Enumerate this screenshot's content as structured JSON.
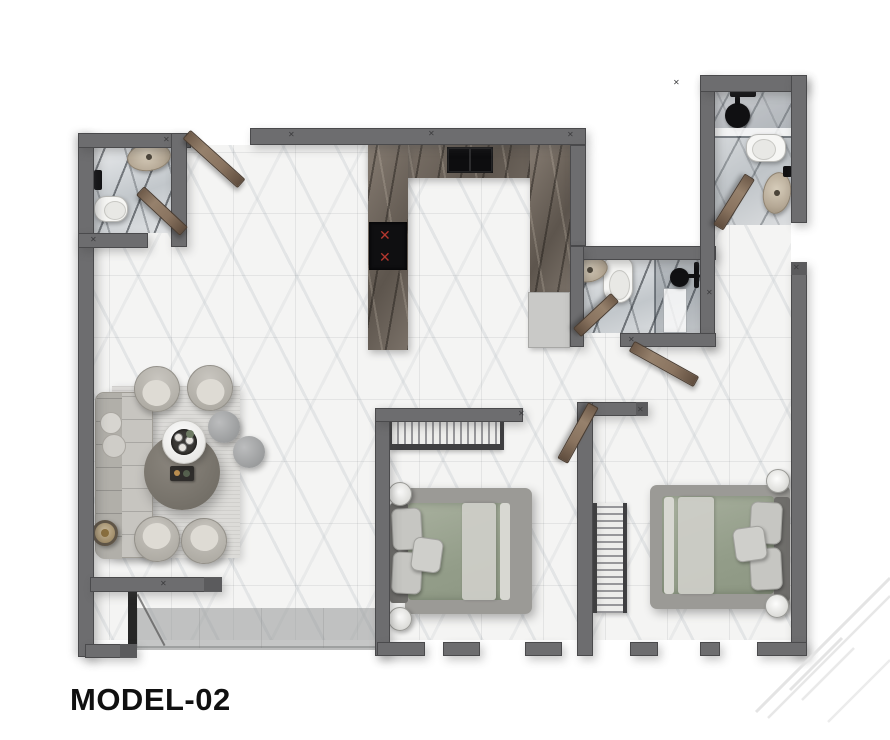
{
  "title": "MODEL-02",
  "plan": {
    "type": "apartment-floor-plan-top-view",
    "rooms": [
      {
        "name": "living-lounge",
        "furniture": [
          "sofa",
          "armchair x4",
          "round-coffee-table-dark",
          "round-coffee-table-white",
          "pouf x2",
          "side-table",
          "area-rug"
        ]
      },
      {
        "name": "kitchen",
        "furniture": [
          "u-shaped-counter",
          "double-sink",
          "cooktop-4-burners",
          "refrigerator"
        ]
      },
      {
        "name": "bathroom-top-left",
        "furniture": [
          "oval-sink",
          "toilet",
          "door-leaf"
        ]
      },
      {
        "name": "bathroom-top-right",
        "furniture": [
          "shower-head",
          "glass-screen",
          "toilet",
          "oval-sink",
          "door-leaf"
        ]
      },
      {
        "name": "bathroom-middle",
        "furniture": [
          "oval-sink",
          "toilet",
          "shower-enclosure",
          "door-leaf"
        ]
      },
      {
        "name": "bedroom-1",
        "furniture": [
          "double-bed-green-duvet",
          "nightstand x2",
          "open-wardrobe"
        ]
      },
      {
        "name": "bedroom-2",
        "furniture": [
          "double-bed-green-duvet",
          "nightstand x2",
          "open-wardrobe"
        ]
      },
      {
        "name": "entry",
        "furniture": [
          "door-frame",
          "door-swing-line"
        ]
      }
    ],
    "palette": {
      "wall": "#6d6d6f",
      "floor_tile": "#f4f4f3",
      "bath_marble": "#d9dcde",
      "kitchen_counter": "#756c63",
      "wood_door": "#8a7460",
      "duvet_green": "#99a48f",
      "burner_red": "#b3372e",
      "title_color": "#101010",
      "watermark": "#e4e4e4"
    }
  }
}
